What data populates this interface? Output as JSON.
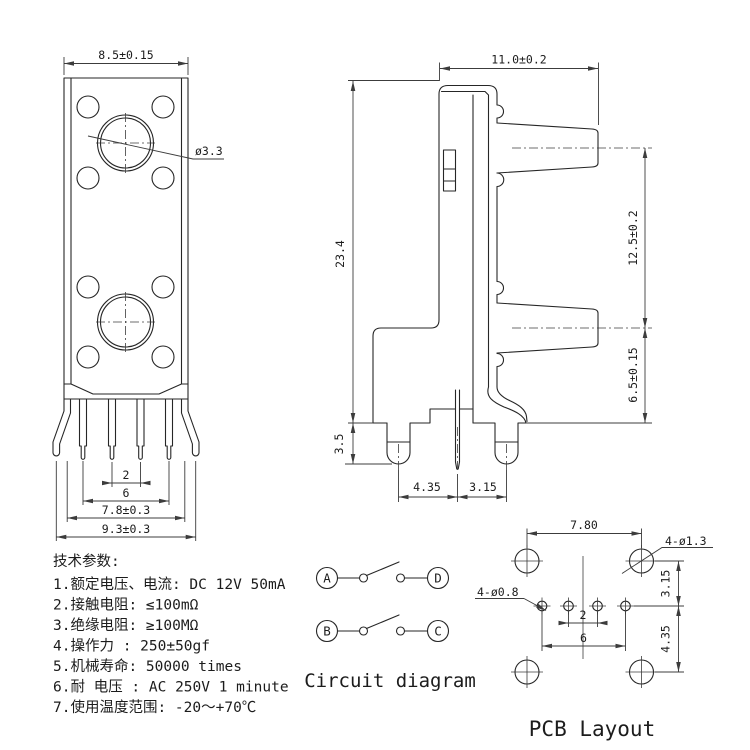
{
  "sheet": {
    "background": "#ffffff",
    "line_color": "#262626"
  },
  "front_view": {
    "dim_width": "8.5±0.15",
    "dim_hole_dia": "ø3.3",
    "dim_pin_pitch": "2",
    "dim_pin_span": "6",
    "dim_leg_span": "7.8±0.3",
    "dim_overall": "9.3±0.3"
  },
  "side_view": {
    "dim_depth": "11.0±0.2",
    "dim_height": "23.4",
    "dim_shaft_pitch": "12.5±0.2",
    "dim_shaft_to_base": "6.5±0.15",
    "dim_pin_length": "3.5",
    "dim_pin_gap_left": "4.35",
    "dim_pin_gap_right": "3.15"
  },
  "tech_params": {
    "title": "技术参数:",
    "items": [
      "1.额定电压、电流: DC 12V 50mA",
      "2.接触电阻: ≤100mΩ",
      "3.绝缘电阻: ≥100MΩ",
      "4.操作力  : 250±50gf",
      "5.机械寿命: 50000 times",
      "6.耐 电压 : AC 250V 1 minute",
      "7.使用温度范围: -20～+70℃"
    ]
  },
  "circuit": {
    "caption": "Circuit diagram",
    "terminal_a": "A",
    "terminal_d": "D",
    "terminal_b": "B",
    "terminal_c": "C"
  },
  "pcb": {
    "caption": "PCB Layout",
    "dim_width": "7.80",
    "label_mount_holes": "4-ø1.3",
    "label_pin_holes": "4-ø0.8",
    "dim_row_top": "3.15",
    "dim_row_bottom": "4.35",
    "dim_pin_pitch": "2",
    "dim_pin_span": "6"
  }
}
